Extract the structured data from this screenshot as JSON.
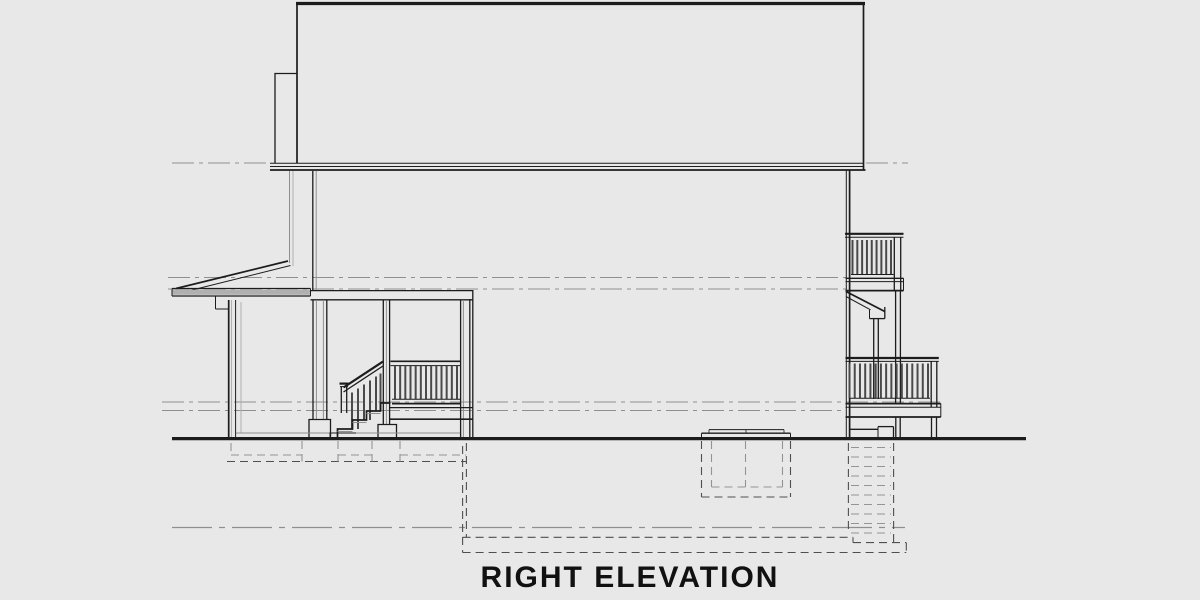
{
  "title": "RIGHT ELEVATION",
  "colors": {
    "background": "#e8e8e8",
    "line_dark": "#1c1c1c",
    "line_gray": "#8f8f8f",
    "line_light": "#ababab",
    "baluster": "#4a4a4a",
    "dashed_dark": "#4f4f4f",
    "dashed_gray": "#949494",
    "fascia_fill": "#b0b0b0",
    "title_color": "#111111"
  }
}
